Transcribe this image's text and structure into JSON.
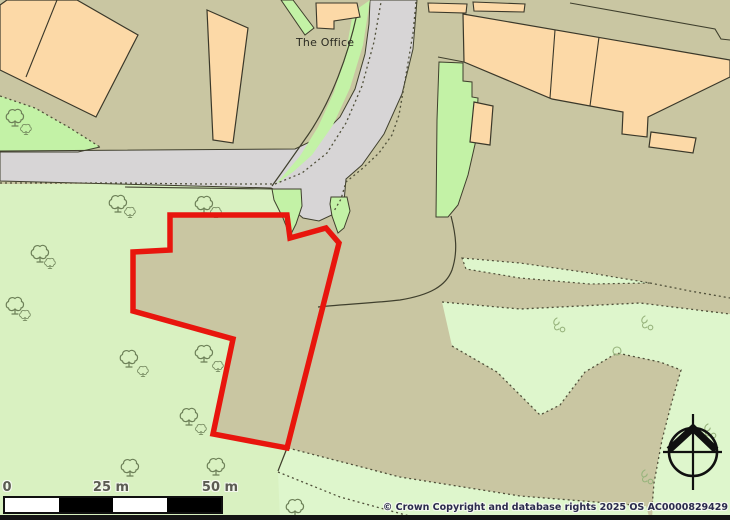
{
  "map": {
    "labels": {
      "office": "The Office"
    },
    "scale_bar": {
      "labels": [
        "0",
        "25 m",
        "50 m"
      ],
      "segments": [
        "#ffffff",
        "#000000",
        "#ffffff",
        "#000000"
      ]
    },
    "copyright": "© Crown Copyright and database rights 2025 OS AC0000829429",
    "colors": {
      "tan": "#c9c6a2",
      "paleA": "#d9f1c1",
      "paleB": "#def6cc",
      "bright": "#c3f2a6",
      "road": "#d7d5d6",
      "line": "#3f3f2d",
      "dash": "#50503a",
      "bld": "#fcd9a7",
      "bldStroke": "#3a382a",
      "red": "#e8150d",
      "black": "#101010",
      "tree": "#6d8058",
      "grass": "#98b47d"
    },
    "geometry": {
      "terrain": [
        {
          "n": "field-bottom-left",
          "t": "polygon",
          "p": "0,184 300,184 300,216 170,215 170,250 133,252 133,311 233,339 213,434 287,448 278,472 413,517 418,520 0,520",
          "f": "paleA"
        },
        {
          "n": "verge-wedge-topleft",
          "t": "polygon",
          "p": "0,96 35,108 70,128 100,147 78,152 30,153 0,151",
          "f": "bright"
        },
        {
          "n": "grass-strip-bottom",
          "t": "polygon",
          "p": "288,448 400,477 520,496 646,506 650,520 280,520 278,472",
          "f": "paleB"
        },
        {
          "n": "grass-field-right",
          "t": "polygon",
          "p": "442,302 520,309 640,303 730,314 730,520 652,520 654,483 662,440 671,405 681,370 660,362 617,353 585,372 560,405 540,415 515,390 497,372 452,346",
          "f": "paleB"
        },
        {
          "n": "grass-wedge-mid",
          "t": "polygon",
          "p": "462,258 520,263 590,273 650,283 590,284 520,278 466,269",
          "f": "paleB",
          "s": "dash",
          "w": 1.2,
          "da": "2,3"
        },
        {
          "n": "road",
          "t": "polygon",
          "p": "0,151 295,149 320,137 340,117 355,89 365,54 369,24 370,0 417,0 413,49 402,94 384,134 362,165 346,179 344,202 334,214 319,221 303,218 290,207 284,194 271,188 0,181",
          "f": "road",
          "s": "line",
          "w": 1
        },
        {
          "n": "road-verge-west",
          "t": "polygon",
          "p": "370,0 363,45 350,88 333,125 312,155 293,172 276,184 283,176 300,156 318,127 334,92 346,52 353,12",
          "f": "bright"
        },
        {
          "n": "office-green-strip",
          "t": "polygon",
          "p": "281,0 293,0 314,28 305,35",
          "f": "bright",
          "s": "line",
          "w": 1
        },
        {
          "n": "entrance-verge-west",
          "t": "polygon",
          "p": "272,189 301,189 302,206 296,224 290,236 283,218 274,200",
          "f": "bright",
          "s": "line",
          "w": 1
        },
        {
          "n": "entrance-verge-east",
          "t": "polygon",
          "p": "331,197 347,197 350,211 344,228 338,233 332,216 330,204",
          "f": "bright",
          "s": "line",
          "w": 1
        },
        {
          "n": "green-strip-east",
          "t": "polygon",
          "p": "439,62 463,63 463,81 472,82 472,97 478,98 476,140 468,175 458,205 448,217 436,217 437,120",
          "f": "bright",
          "s": "line",
          "w": 1
        },
        {
          "n": "plot-curve-office",
          "t": "path",
          "p": "M357,14 C348,55 332,100 308,135 C296,152 285,168 272,186",
          "s": "line",
          "w": 1.2
        },
        {
          "n": "field-line-east",
          "t": "path",
          "p": "M451,216 C456,235 458,252 452,270 C446,286 430,295 400,300 C375,303 345,304 318,307",
          "s": "line",
          "w": 1.2
        },
        {
          "n": "verge-bottom-line",
          "t": "path",
          "p": "M0,152 L78,152 L100,147",
          "s": "line",
          "w": 1.1
        },
        {
          "n": "field-top-line",
          "t": "path",
          "p": "M125,187 L272,189",
          "s": "line",
          "w": 1.1
        },
        {
          "n": "plot-line-topright",
          "t": "path",
          "p": "M570,3 L715,29 L721,39 L730,40",
          "s": "line",
          "w": 1.1
        },
        {
          "n": "strip-top-line",
          "t": "path",
          "p": "M438,57 L464,62",
          "s": "line",
          "w": 1.1
        },
        {
          "n": "boundary-connector-line",
          "t": "path",
          "p": "M287,448 L278,471",
          "s": "line",
          "w": 1.2
        },
        {
          "n": "dash-verge-topleft",
          "t": "polyline",
          "p": "0,96 35,108 70,128 100,147",
          "s": "dash",
          "w": 1.3,
          "da": "2,3"
        },
        {
          "n": "dash-road-south",
          "t": "polyline",
          "p": "0,183 120,183 200,184 275,184 302,173 327,153 346,123 362,86 374,42 381,2",
          "s": "dash",
          "w": 1.3,
          "da": "2,3"
        },
        {
          "n": "dash-road-east",
          "t": "polyline",
          "p": "416,2 413,33 408,63 403,92 399,115 392,135 379,153 363,168 346,182 341,199 334,211",
          "s": "dash",
          "w": 1.3,
          "da": "2,3"
        },
        {
          "n": "dash-wedge-cont",
          "t": "polyline",
          "p": "650,283 690,291 730,298",
          "s": "dash",
          "w": 1.3,
          "da": "2,3"
        },
        {
          "n": "dash-field-top",
          "t": "polyline",
          "p": "442,302 520,309 640,303 730,314",
          "s": "dash",
          "w": 1.3,
          "da": "2,3"
        },
        {
          "n": "dash-field-bottom",
          "t": "polyline",
          "p": "452,346 497,372 515,390 540,415 560,405 585,372 617,353 660,362 681,370 671,405 662,440 654,483 652,507",
          "s": "dash",
          "w": 1.3,
          "da": "2,3"
        },
        {
          "n": "dash-parcel-south",
          "t": "polyline",
          "p": "288,448 400,477 520,496 646,506",
          "s": "dash",
          "w": 1.3,
          "da": "2,3"
        },
        {
          "n": "dash-parcel-south2",
          "t": "polyline",
          "p": "278,472 340,497 413,517",
          "s": "dash",
          "w": 1.3,
          "da": "2,3"
        },
        {
          "n": "grass-tuft-circle",
          "t": "circle",
          "p": "617,351,4",
          "s": "grass",
          "w": 1.1
        },
        {
          "n": "building-topleft",
          "t": "polygon",
          "p": "0,5 7,0 77,0 138,35 96,117 0,70",
          "f": "bld",
          "s": "bldStroke",
          "w": 1.2
        },
        {
          "n": "building-topleft-divider",
          "t": "path",
          "p": "M57,0 L26,77",
          "s": "bldStroke",
          "w": 1.1
        },
        {
          "n": "building-tall-left",
          "t": "polygon",
          "p": "207,10 248,28 233,143 213,140",
          "f": "bld",
          "s": "bldStroke",
          "w": 1.2
        },
        {
          "n": "building-office",
          "t": "polygon",
          "p": "316,3 357,3 360,17 334,21 334,29 317,28",
          "f": "bld",
          "s": "bldStroke",
          "w": 1.1
        },
        {
          "n": "building-row-a",
          "t": "polygon",
          "p": "428,3 467,4 466,13 429,12",
          "f": "bld",
          "s": "bldStroke",
          "w": 1.1
        },
        {
          "n": "building-row-b",
          "t": "polygon",
          "p": "473,2 525,4 524,12 474,11",
          "f": "bld",
          "s": "bldStroke",
          "w": 1.1
        },
        {
          "n": "building-main-row",
          "t": "polygon",
          "p": "463,14 730,60 730,77 648,117 647,137 622,134 623,112 590,106 552,99 464,62",
          "f": "bld",
          "s": "bldStroke",
          "w": 1.2
        },
        {
          "n": "building-main-divider-1",
          "t": "path",
          "p": "M555,30 L550,98",
          "s": "bldStroke",
          "w": 1.1
        },
        {
          "n": "building-main-divider-2",
          "t": "path",
          "p": "M599,37 L590,106",
          "s": "bldStroke",
          "w": 1.1
        },
        {
          "n": "building-small-right",
          "t": "polygon",
          "p": "651,132 696,138 693,153 649,147",
          "f": "bld",
          "s": "bldStroke",
          "w": 1.2
        },
        {
          "n": "building-small-mid",
          "t": "polygon",
          "p": "474,102 493,106 490,145 470,142",
          "f": "bld",
          "s": "bldStroke",
          "w": 1.2
        }
      ],
      "trees": [
        [
          15,
          117,
          1
        ],
        [
          26,
          129,
          0.62
        ],
        [
          118,
          203,
          1
        ],
        [
          130,
          212,
          0.62
        ],
        [
          204,
          204,
          1
        ],
        [
          216,
          212,
          0.62
        ],
        [
          40,
          253,
          1
        ],
        [
          50,
          263,
          0.62
        ],
        [
          15,
          305,
          1
        ],
        [
          25,
          315,
          0.62
        ],
        [
          129,
          358,
          1
        ],
        [
          143,
          371,
          0.62
        ],
        [
          204,
          353,
          1
        ],
        [
          218,
          366,
          0.62
        ],
        [
          189,
          416,
          1
        ],
        [
          201,
          429,
          0.62
        ],
        [
          130,
          467,
          1
        ],
        [
          216,
          466,
          1
        ],
        [
          295,
          507,
          1
        ]
      ],
      "grass": [
        [
          557,
          318
        ],
        [
          645,
          316
        ],
        [
          708,
          424
        ],
        [
          645,
          470
        ]
      ],
      "overlays": [
        {
          "n": "site-boundary",
          "t": "polygon",
          "p": "170,215 287,215 290,238 326,228 339,243 287,448 213,434 233,339 133,311 133,252 170,250",
          "s": "red",
          "w": 5.5
        },
        {
          "n": "compass-circle",
          "t": "circle",
          "p": "693,452,24",
          "s": "black",
          "w": 2.6
        },
        {
          "n": "compass-vline",
          "t": "path",
          "p": "M693,414 L693,490",
          "s": "black",
          "w": 2.2
        },
        {
          "n": "compass-hline",
          "t": "path",
          "p": "M663,452 L722,452",
          "s": "black",
          "w": 2.2
        },
        {
          "n": "compass-north-arrow",
          "t": "polyline",
          "p": "669,450 693,428 716,450",
          "s": "black",
          "w": 7
        }
      ]
    }
  }
}
